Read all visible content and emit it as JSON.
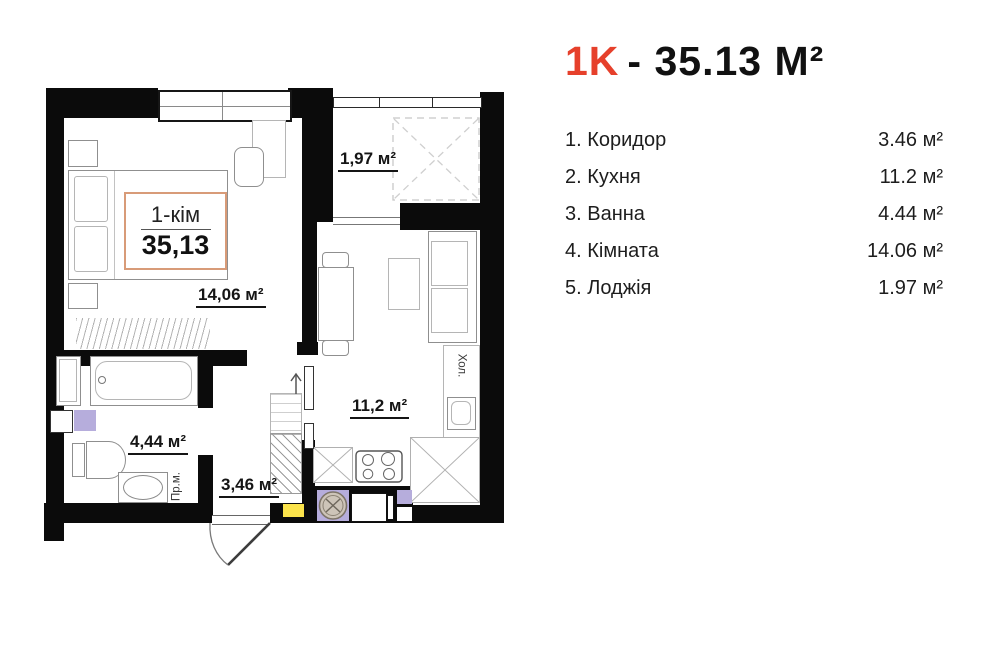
{
  "title": {
    "code": "1K",
    "rest": "- 35.13 М²"
  },
  "legend": [
    {
      "label": "1. Коридор",
      "value": "3.46 м²"
    },
    {
      "label": "2. Кухня",
      "value": "11.2 м²"
    },
    {
      "label": "3. Ванна",
      "value": "4.44 м²"
    },
    {
      "label": "4. Кімната",
      "value": "14.06 м²"
    },
    {
      "label": "5. Лоджія",
      "value": "1.97 м²"
    }
  ],
  "plan": {
    "unit_box": {
      "type": "1-кім",
      "area": "35,13"
    },
    "labels": {
      "room": "14,06 м²",
      "loggia": "1,97 м²",
      "kitchen": "11,2 м²",
      "bathroom": "4,44 м²",
      "corridor": "3,46 м²",
      "washing_machine": "Пр.м.",
      "fridge": "Хол."
    },
    "colors": {
      "wall": "#0b0b0b",
      "accent_red": "#e6402b",
      "threshold_yellow": "#fbe34b",
      "appliance_purple": "#b6addc",
      "unit_box_border": "#d89b78"
    }
  }
}
